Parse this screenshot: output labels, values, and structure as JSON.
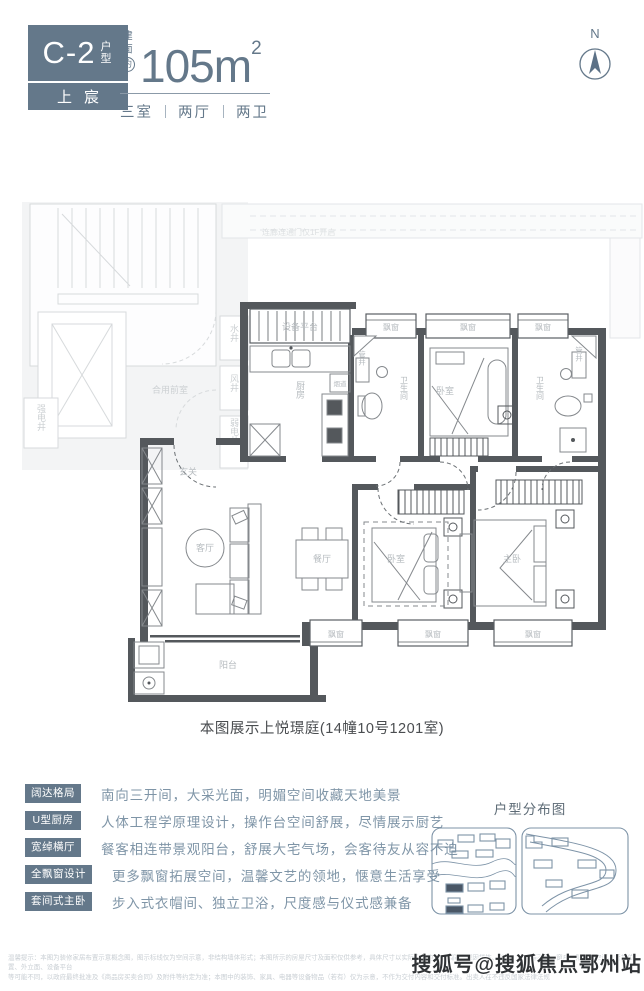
{
  "header": {
    "unit_code": "C-2",
    "unit_type_label": "户型",
    "brand": "上宸",
    "area_label": [
      "建",
      "面",
      "约"
    ],
    "area_value": "105m",
    "area_unit_sup": "2",
    "layout_rooms": "三室",
    "layout_halls": "两厅",
    "layout_baths": "两卫",
    "compass": "N"
  },
  "floor_plan": {
    "labels": {
      "corridor_note": "连廊连通门仅1F开启",
      "water_shaft": "水井",
      "air_shaft": "风井",
      "weak_elec_shaft": "弱电井",
      "strong_elec_shaft": "强电井",
      "shared_lobby": "合用前室",
      "equipment_platform": "设备平台",
      "kitchen": "厨房",
      "flue": "烟道",
      "pipe_shaft": "管井",
      "bathroom": "卫生间",
      "bay_window": "飘窗",
      "bedroom": "卧室",
      "master_bedroom": "主卧",
      "entry": "玄关",
      "living_room": "客厅",
      "dining_room": "餐厅",
      "balcony": "阳台"
    },
    "caption": "本图展示上悦璟庭(14幢10号1201室)"
  },
  "features": [
    {
      "tag": "阔达格局",
      "desc": "南向三开间，大采光面，明媚空间收藏天地美景"
    },
    {
      "tag": "U型厨房",
      "desc": "人体工程学原理设计，操作台空间舒展，尽情展示厨艺"
    },
    {
      "tag": "宽绰横厅",
      "desc": "餐客相连带景观阳台，舒展大宅气场，会客待友从容不迫"
    },
    {
      "tag": "全飘窗设计",
      "desc": "更多飘窗拓展空间，温馨文艺的领地，惬意生活享受"
    },
    {
      "tag": "套间式主卧",
      "desc": "步入式衣帽间、独立卫浴，尺度感与仪式感兼备"
    }
  ],
  "distribution_map": {
    "title": "户型分布图"
  },
  "disclaimer": {
    "line1": "温馨提示：本图为装修家居布置示意概念图，图示标线仅为空间示意，非结构墙体形式；本图所示的房屋尺寸及面积仅供参考，具体尺寸以实际交付为准。相同户型因楼栋、单元、楼层等不同，窗户、阳台、空调、管井位置、外立面、设备平台",
    "line2": "等可能不同，以政府最终批准及《商品房买卖合同》及附件等约定为准；本图中的装饰、家具、电器等设备物品（若有）仅为示意，不作为交付内容和交付标准。出卖人在不违反国家法律法规"
  },
  "watermark": "搜狐号@搜狐焦点鄂州站",
  "colors": {
    "accent": "#64788a",
    "wall": "#54585c"
  }
}
